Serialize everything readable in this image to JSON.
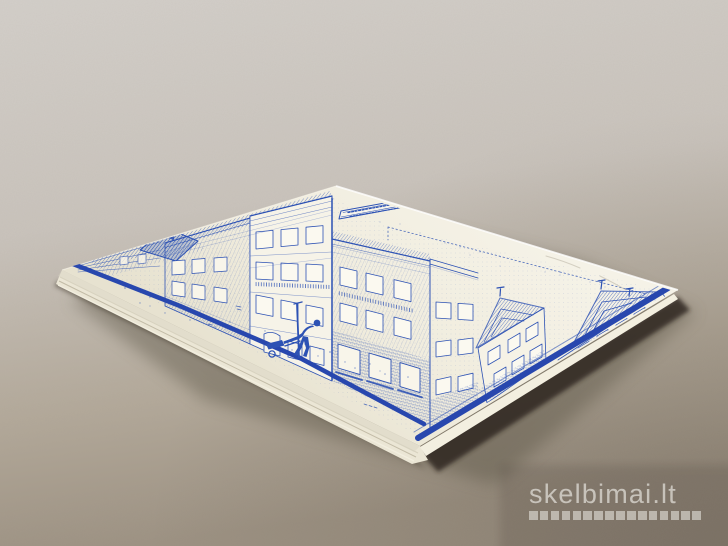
{
  "image": {
    "width": 728,
    "height": 546,
    "alt": "Photograph of a square booklet lying on a grey surface; its cream cover bears a blue line-print of Dutch canal-house facades with a gabled roof, a tiny title banner and a figure pushing a handcart"
  },
  "colors": {
    "bg_top": "#d2cec9",
    "bg_mid": "#c6c0b8",
    "bg_bottom": "#9e9383",
    "cover": "#f2efe2",
    "cover_shade": "#e7e2d0",
    "ink": "#2d52b4",
    "stripe": "#2847ae",
    "page_edge": "#ebe6d5",
    "dark_edge": "#29241d",
    "shadow": "#564e3f",
    "watermark_text": "#dcd9d2"
  },
  "watermark": {
    "text": "skelbimai.lt",
    "squares_count": 16
  }
}
